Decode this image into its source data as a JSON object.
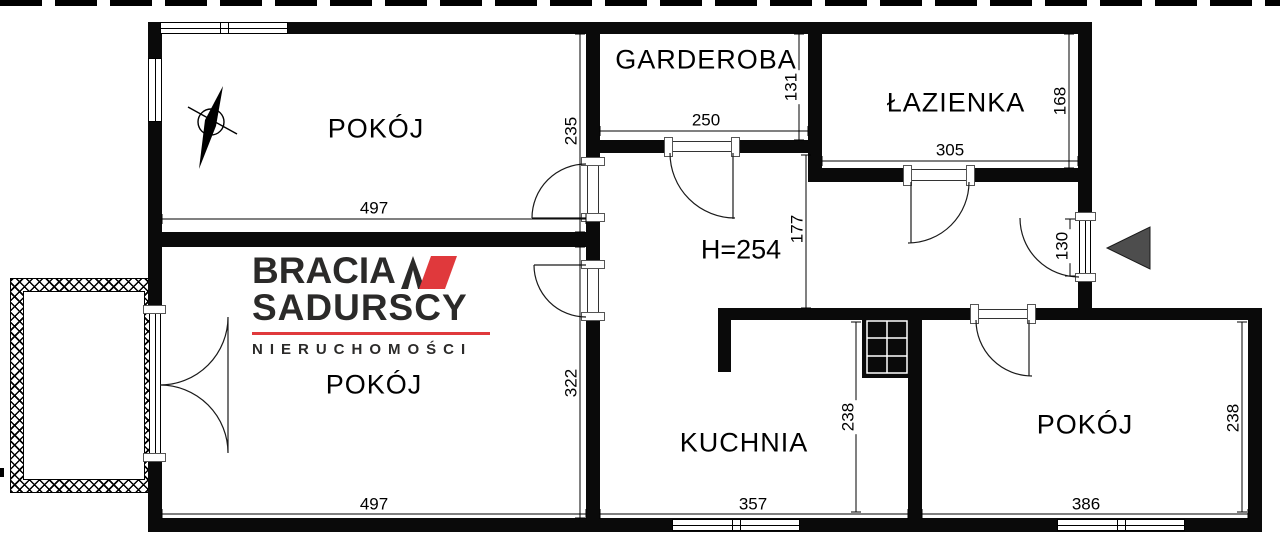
{
  "brand": {
    "line1": "BRACIA",
    "line2": "SADURSCY",
    "line3": "NIERUCHOMOŚCI"
  },
  "colors": {
    "brand_red": "#e0393c",
    "logo_ink": "#2b2a29",
    "wall": "#0a0a0a",
    "entry_arrow": "#4d4d4d"
  },
  "labels": {
    "room_tl": "POKÓJ",
    "garderoba": "GARDEROBA",
    "lazienka": "ŁAZIENKA",
    "room_bl": "POKÓJ",
    "kuchnia": "KUCHNIA",
    "room_br": "POKÓJ"
  },
  "dims": {
    "ceiling": "H=254",
    "room_tl_width": "497",
    "room_tl_depth": "235",
    "garderoba_width": "250",
    "garderoba_depth": "131",
    "lazienka_width": "305",
    "lazienka_depth": "168",
    "hall_depth": "177",
    "entry_width": "130",
    "room_bl_width": "497",
    "room_bl_depth": "322",
    "kuchnia_width": "357",
    "kuchnia_depth": "238",
    "room_br_width": "386",
    "room_br_depth": "238"
  }
}
